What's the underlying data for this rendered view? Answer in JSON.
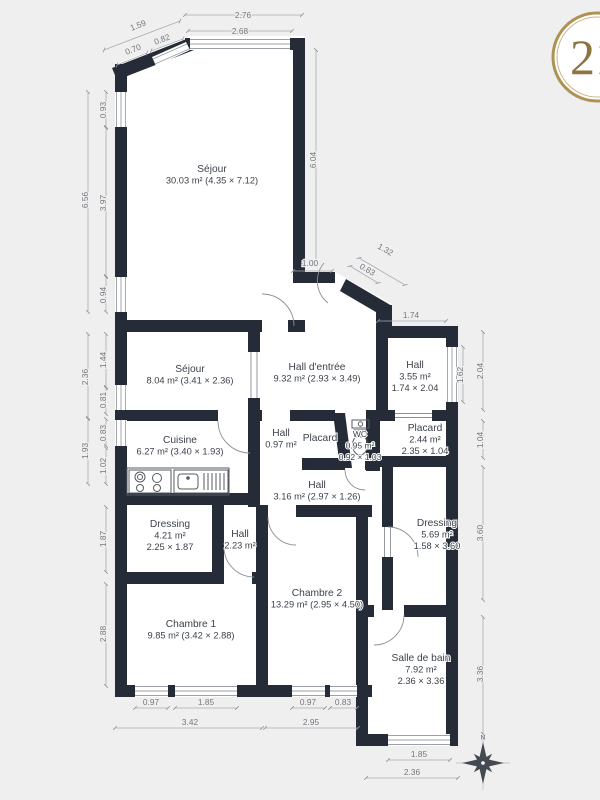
{
  "branding": {
    "logo_text": "21",
    "ring_color": "#ad9254"
  },
  "compass": {
    "north_label": "N"
  },
  "rooms": {
    "sejour_main": {
      "name": "Séjour",
      "l2": "30.03 m² (4.35 × 7.12)"
    },
    "sejour_small": {
      "name": "Séjour",
      "l2": "8.04 m² (3.41 × 2.36)"
    },
    "hall_entree": {
      "name": "Hall d'entrée",
      "l2": "9.32 m² (2.93 × 3.49)"
    },
    "hall_right": {
      "name": "Hall",
      "l2": "3.55 m²",
      "l3": "1.74 × 2.04"
    },
    "cuisine": {
      "name": "Cuisine",
      "l2": "6.27 m² (3.40 × 1.93)"
    },
    "hall_small": {
      "name": "Hall",
      "l2": "0.97 m²"
    },
    "placard_small": {
      "name": "Placard"
    },
    "wc": {
      "name": "WC",
      "l2": "0.95 m²",
      "l3": "0.92 × 1.03"
    },
    "placard_right": {
      "name": "Placard",
      "l2": "2.44 m²",
      "l3": "2.35 × 1.04"
    },
    "hall_central": {
      "name": "Hall",
      "l2": "3.16 m² (2.97 × 1.26)"
    },
    "dressing_left": {
      "name": "Dressing",
      "l2": "4.21 m²",
      "l3": "2.25 × 1.87"
    },
    "hall_inner": {
      "name": "Hall",
      "l2": "2.23 m²"
    },
    "dressing_right": {
      "name": "Dressing",
      "l2": "5.69 m²",
      "l3": "1.58 × 3.60"
    },
    "chambre1": {
      "name": "Chambre 1",
      "l2": "9.85 m² (3.42 × 2.88)"
    },
    "chambre2": {
      "name": "Chambre 2",
      "l2": "13.29 m² (2.95 × 4.50)"
    },
    "sdb": {
      "name": "Salle de bain",
      "l2": "7.92 m²",
      "l3": "2.36 × 3.36"
    }
  },
  "dim": {
    "top_total": "2.76",
    "top_window": "2.68",
    "bay_total": "1.59",
    "bay_wall": "0.70",
    "bay_window": "0.82",
    "left_window_top": "0.93",
    "left_total_upper": "6.56",
    "left_wall_mid": "3.97",
    "left_window_lower": "0.94",
    "left_sejour_total": "2.36",
    "left_sejour_wall": "1.44",
    "left_sejour_window": "0.81",
    "left_cuisine_total": "1.93",
    "left_cuisine_window": "0.83",
    "left_cuisine_wall": "1.02",
    "left_dressing": "1.87",
    "left_chambre1": "2.88",
    "sejour_height": "6.04",
    "entree_top": "1.00",
    "entry_total": "1.32",
    "entry_door": "0.83",
    "hall_width": "1.74",
    "hall_window": "1.62",
    "hall_height": "2.04",
    "placard_height": "1.04",
    "dressing_height": "3.60",
    "sdb_height": "3.36",
    "c1_window_small": "0.97",
    "c1_window_large": "1.85",
    "c1_total": "3.42",
    "c2_window": "0.97",
    "c2_window2": "0.83",
    "c2_total": "2.95",
    "sdb_window": "1.85",
    "sdb_width": "2.36"
  }
}
